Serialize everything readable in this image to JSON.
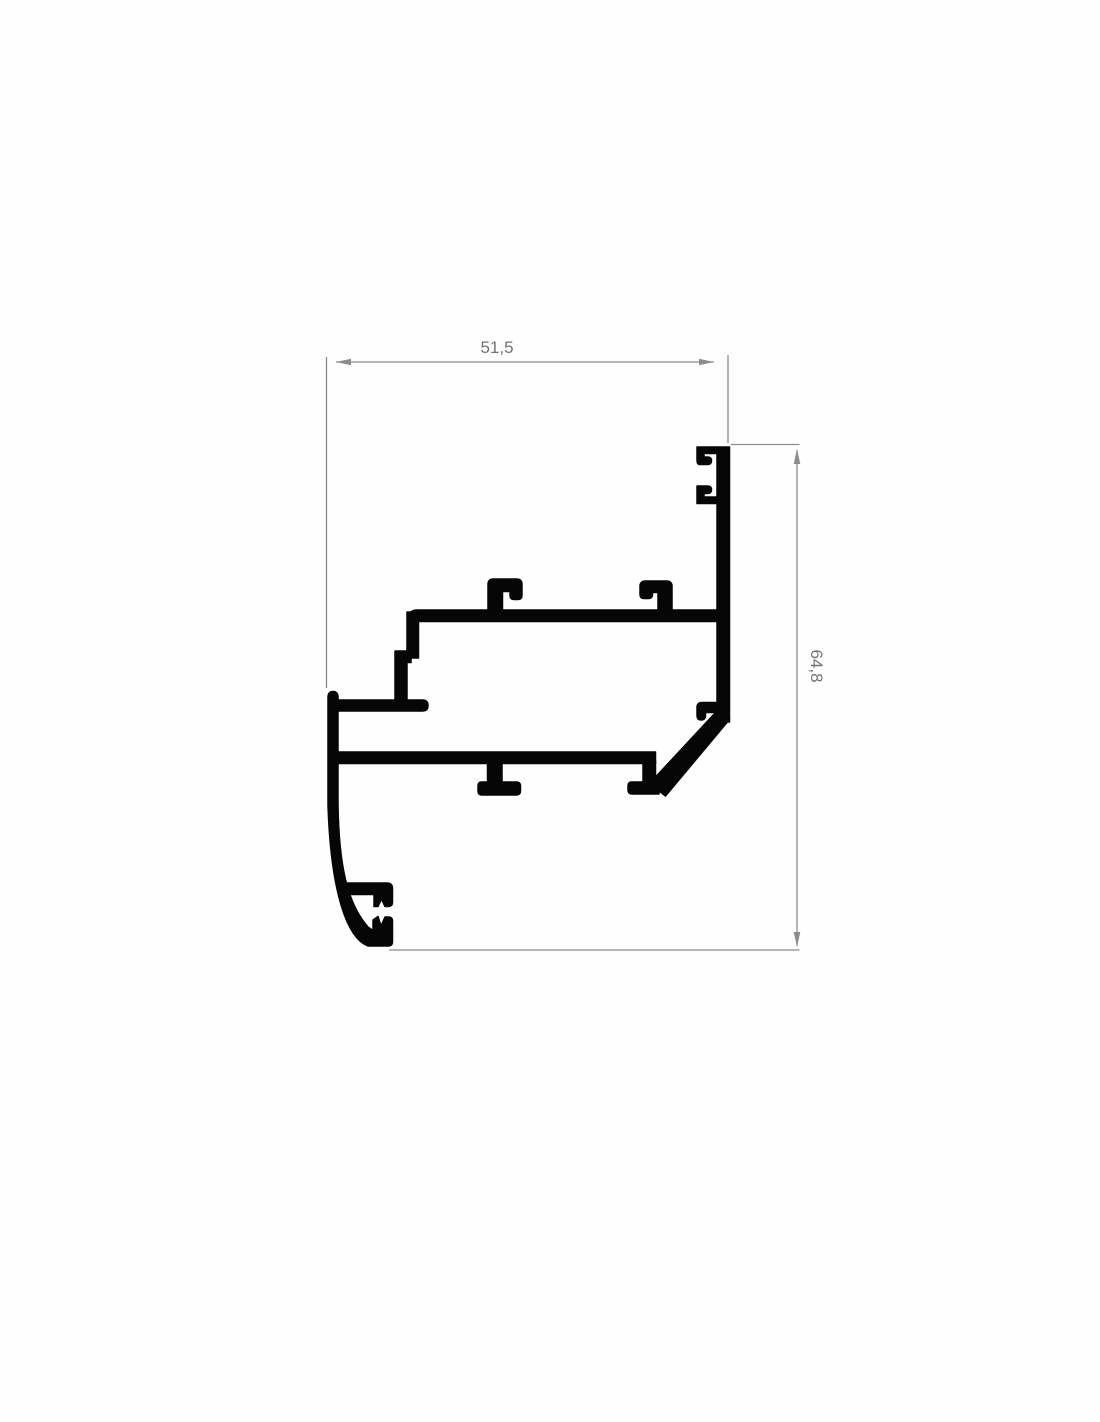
{
  "drawing": {
    "dimension_labels": {
      "width": "51,5",
      "height": "64,8"
    },
    "colors": {
      "profile": "#060606",
      "dimension_line": "#8c8c8c",
      "dimension_text": "#737373",
      "background": "#fefefe"
    }
  }
}
